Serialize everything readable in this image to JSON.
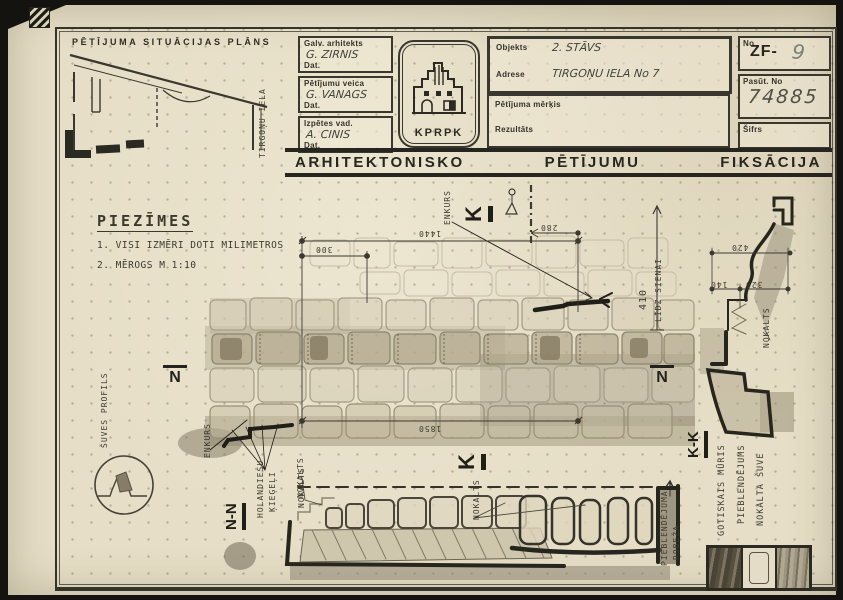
{
  "header": {
    "site_plan": {
      "title": "PĒTĪJUMA SITUĀCIJAS PLĀNS",
      "street": "TIRGOŅU IELA"
    },
    "signatures": [
      {
        "role": "Galv. arhitekts",
        "name": "G. ZIRNIS",
        "date": "Dat."
      },
      {
        "role": "Pētījumu veica",
        "name": "G. VANAGS",
        "date": "Dat."
      },
      {
        "role": "Izpētes vad.",
        "name": "A. CINIS",
        "date": "Dat."
      }
    ],
    "logo": {
      "text": "KPRPK"
    },
    "object_box": {
      "objekts_label": "Objekts",
      "objekts_value": "2. STĀVS",
      "adrese_label": "Adrese",
      "adrese_value": "TIRGOŅU IELA   No 7",
      "merkis_label": "Pētījuma mērķis",
      "rezultats_label": "Rezultāts"
    },
    "number_box": {
      "no_label": "No",
      "no_prefix": "ZF-",
      "no_value": "9",
      "pasut_label": "Pasūt. No",
      "pasut_value": "74885",
      "sifrs_label": "Šifrs"
    }
  },
  "banner": {
    "word1": "ARHITEKTONISKO",
    "word2": "PĒTĪJUMU",
    "word3": "FIKSĀCIJA"
  },
  "notes": {
    "title": "PIEZĪMES",
    "line1": "1. VISI IZMĒRI DOTI MILIMETROS",
    "line2": "2. MĒROGS M 1:10"
  },
  "elevation": {
    "dim_top": "1440",
    "dim_sub": "300",
    "dim_bottom": "1850",
    "dim_obz": "280",
    "dim_wall": "410",
    "dim_wall_text": "LĪDZ SIENAI",
    "enkurs": "ENKURS",
    "marker_k": "K",
    "marker_n": "N",
    "holandiesu_l1": "HOLANDIEŠU",
    "holandiesu_l2": "ĶIEĢEĻI",
    "nokalts": "NOKALTS"
  },
  "section_kk": {
    "marker": "K-K",
    "dim1": "420",
    "dim2": "140",
    "dim3": "320",
    "nokalts": "NOKALTS"
  },
  "section_nn": {
    "marker": "N-N",
    "nokalts": "NOKALTS",
    "robeza_l1": "PIEBLENDĒJUMA",
    "robeza_l2": "ROBEŽA"
  },
  "detail": {
    "suves_profils": "ŠUVES PROFILS"
  },
  "legend": {
    "items": [
      "GOTISKAIS MŪRIS",
      "PIEBLENDĒJUMS",
      "NOKALTA ŠUVE"
    ]
  }
}
